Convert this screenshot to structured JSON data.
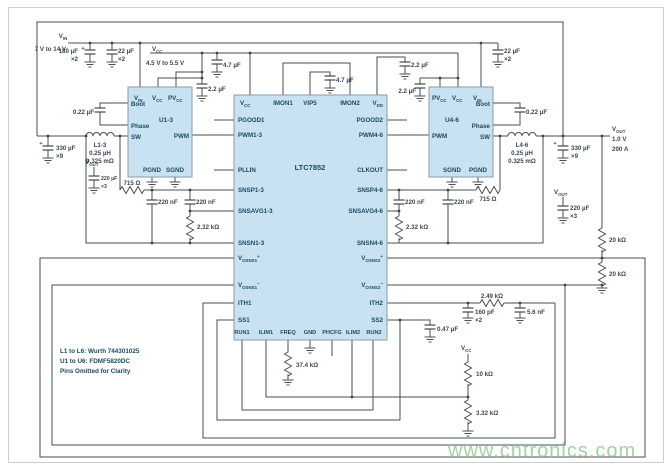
{
  "watermark": "www.cntronics.com",
  "notes": {
    "l1": "L1 to L6: Wurth 744301025",
    "l2": "U1 to U6: FDMF5820DC",
    "l3": "Pins Omitted for Clarity"
  },
  "nets": {
    "vin_b": "V",
    "vin_s": "IN",
    "vin_range": "7 V to 14 V",
    "vcc_b": "V",
    "vcc_s": "CC",
    "vcc_range": "4.5 V to 5.5 V",
    "vout_b": "V",
    "vout_s": "OUT",
    "vout_v": "1.0 V",
    "vout_a": "200 A",
    "voutstub_b": "V",
    "voutstub_s": "OUT",
    "vccdiv_b": "V",
    "vccdiv_s": "CC"
  },
  "ic": {
    "part": "LTC7852",
    "pins": {
      "vcc_b": "V",
      "vcc_s": "CC",
      "imon1": "IMON1",
      "vip5": "VIP5",
      "imon2": "IMON2",
      "vdd_b": "V",
      "vdd_s": "DD",
      "pgood1": "PGOOD1",
      "pwm13": "PWM1-3",
      "pllin": "PLLIN",
      "snsp13": "SNSP1-3",
      "snsavg13": "SNSAVG1-3",
      "snsn13": "SNSN1-3",
      "vosns1p_b": "V",
      "vosns1p_s": "OSNS1",
      "vosns1p_x": "+",
      "vosns1n_b": "V",
      "vosns1n_s": "OSNS1",
      "vosns1n_x": "−",
      "ith1": "ITH1",
      "ss1": "SS1",
      "run1": "RUN1",
      "ilim1": "ILIM1",
      "freq": "FREQ",
      "gnd": "GND",
      "phcfg": "PHCFG",
      "ilim2": "ILIM2",
      "run2": "RUN2",
      "pgood2": "PGOOD2",
      "pwm46": "PWM4-6",
      "clkout": "CLKOUT",
      "snsp46": "SNSP4-6",
      "snsavg46": "SNSAVG4-6",
      "snsn46": "SNSN4-6",
      "vosns2p_b": "V",
      "vosns2p_s": "OSNS2",
      "vosns2p_x": "+",
      "vosns2n_b": "V",
      "vosns2n_s": "OSNS2",
      "vosns2n_x": "−",
      "ith2": "ITH2",
      "ss2": "SS2"
    }
  },
  "u13": {
    "name": "U1-3",
    "vin_b": "V",
    "vin_s": "IN",
    "vcc_b": "V",
    "vcc_s": "CC",
    "pvcc_b": "PV",
    "pvcc_s": "CC",
    "boot": "Boot",
    "phase": "Phase",
    "sw": "SW",
    "pwm": "PWM",
    "pgnd": "PGND",
    "sgnd": "SGND"
  },
  "u46": {
    "name": "U4-6",
    "pvcc_b": "PV",
    "pvcc_s": "CC",
    "vcc_b": "V",
    "vcc_s": "CC",
    "vin_b": "V",
    "vin_s": "IN",
    "boot": "Boot",
    "phase": "Phase",
    "sw": "SW",
    "pwm": "PWM",
    "sgnd": "SGND",
    "pgnd": "PGND"
  },
  "comp": {
    "plus": "+",
    "c180": "180 µF",
    "c180_m": "×2",
    "c22_l": "22 µF",
    "c22_l_m": "×2",
    "c22_r": "22 µF",
    "c22_r_m": "×2",
    "c2u2_l": "2.2 µF",
    "c4u7_l": "4.7 µF",
    "c4u7_vip5": "4.7 µF",
    "c2u2_vdd": "2.2 µF",
    "c2u2_r": "2.2 µF",
    "cboot_l": "0.22 µF",
    "cboot_r": "0.22 µF",
    "l_l": "L1-3",
    "l_l_v": "0.25 µH",
    "l_l_r": "0.325 mΩ",
    "l_r": "L4-6",
    "l_r_v": "0.25 µH",
    "l_r_r": "0.325 mΩ",
    "c330_l": "330 µF",
    "c330_l_m": "×9",
    "c330_r": "330 µF",
    "c330_r_m": "×9",
    "c220_l": "220 µF",
    "c220_l_m": "×3",
    "c220_r": "220 µF",
    "c220_r_m": "×3",
    "r715_l": "715 Ω",
    "r715_r": "715 Ω",
    "c220n_l1": "220 nF",
    "c220n_l2": "220 nF",
    "c220n_r1": "220 nF",
    "c220n_r2": "220 nF",
    "r2k32_l": "2.32 kΩ",
    "r2k32_r": "2.32 kΩ",
    "r20k_1": "20 kΩ",
    "r20k_2": "20 kΩ",
    "c160p": "160 pF",
    "c160p_m": "×2",
    "r2k49": "2.49 kΩ",
    "c5n6": "5.6 nF",
    "c470n": "0.47 µF",
    "r37k4": "37.4 kΩ",
    "r10k": "10 kΩ",
    "r3k32": "3.32 kΩ"
  }
}
